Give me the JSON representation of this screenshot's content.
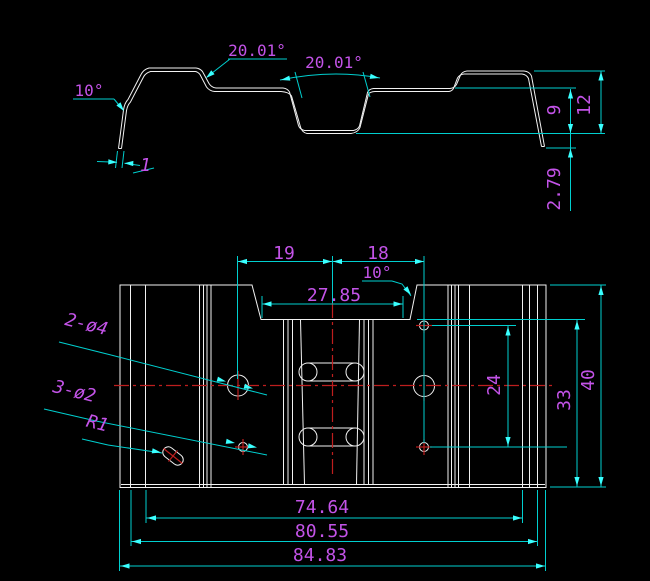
{
  "drawing": {
    "title": "sheet-metal bracket 2-view CAD drawing",
    "colors": {
      "background": "#000000",
      "outline": "#F2F2F2",
      "dimension_line": "#00CFCF",
      "arrowhead": "#3AFFFF",
      "dimension_text": "#C353E8",
      "centerline": "#BE1E1E"
    },
    "labels": {
      "profile": {
        "bend_angle": "10°",
        "step_angle": "20.01°",
        "channel_angle": "20.01°",
        "thickness": "1",
        "inner_height": "9",
        "total_height": "12",
        "flange_offset": "2.79"
      },
      "plan": {
        "left_offset": "19",
        "right_offset": "18",
        "notch_angle": "10°",
        "notch_width": "27.85",
        "large_holes": "2-ø4",
        "small_holes": "3-ø2",
        "slot_radius": "R1",
        "hole_pitch": "24",
        "hole_height": "33",
        "overall_height": "40",
        "inner_width": "74.64",
        "mid_width": "80.55",
        "overall_width": "84.83"
      }
    }
  }
}
